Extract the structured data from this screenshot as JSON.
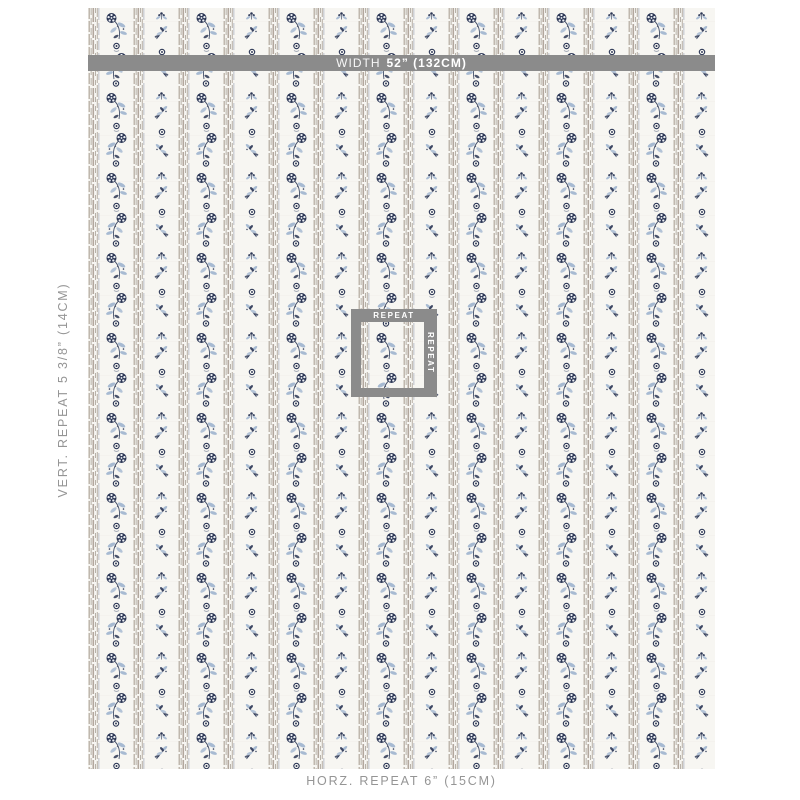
{
  "annotations": {
    "width_bar": {
      "prefix": "WIDTH",
      "value": "52” (132CM)"
    },
    "vertical_repeat_label": "VERT. REPEAT  5 3/8” (14CM)",
    "horizontal_repeat_label": "HORZ. REPEAT 6” (15CM)",
    "repeat_box": {
      "top_label": "REPEAT",
      "side_label": "REPEAT"
    }
  },
  "colors": {
    "annotation_gray": "#8b8b8b",
    "annotation_text": "#ffffff",
    "label_text_gray": "#959595",
    "fabric_ground": "#f7f6f2",
    "stripe_taupe": "#a49c92",
    "floral_navy": "#2b3655",
    "floral_light_blue": "#a7bad2"
  }
}
